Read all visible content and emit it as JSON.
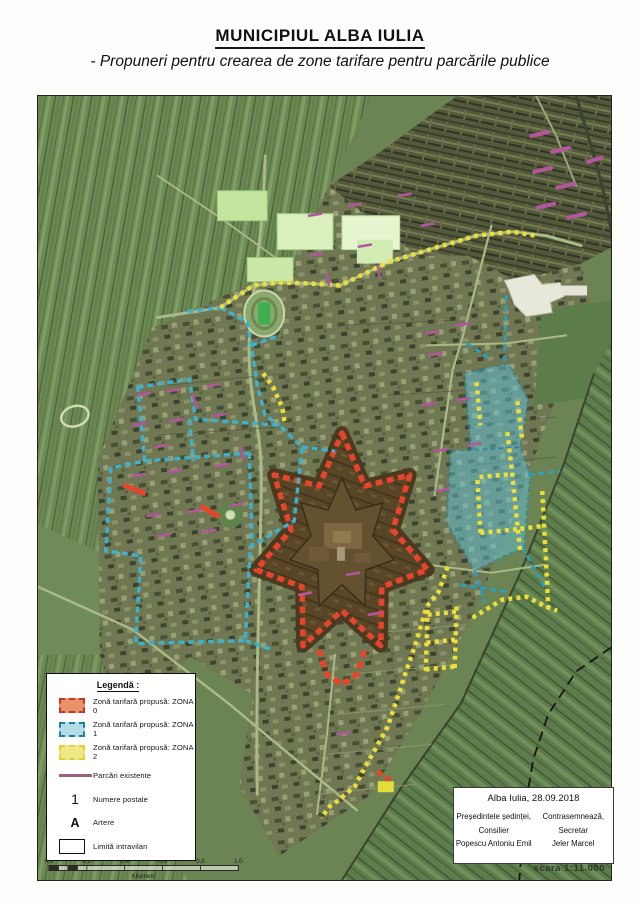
{
  "title": "MUNICIPIUL ALBA IULIA",
  "subtitle": "- Propuneri pentru crearea de zone tarifare pentru parcările publice",
  "legend": {
    "title": "Legendă :",
    "items": [
      {
        "label": "Zonă tarifară propusă: ZONA 0"
      },
      {
        "label": "Zonă tarifară propusă: ZONA 1"
      },
      {
        "label": "Zonă tarifară propusă: ZONA 2"
      },
      {
        "label": "Parcări existente"
      },
      {
        "label": "Numere postale",
        "symbol": "1"
      },
      {
        "label": "Artere",
        "symbol": "A"
      },
      {
        "label": "Limită intravilan"
      }
    ]
  },
  "stamp": {
    "date_line": "Alba Iulia, 28.09.2018",
    "left": {
      "role": "Președintele ședinței,",
      "title": "Consilier",
      "name": "Popescu Antoniu Emil"
    },
    "right": {
      "role": "Contrasemnează,",
      "title": "Secretar",
      "name": "Jeler Marcel"
    }
  },
  "scale": {
    "text": "scara 1:11.000",
    "ticks": [
      "0,0",
      "0,2",
      "0,4",
      "0,6",
      "0,8",
      "1,0"
    ],
    "unit": "Kilometri"
  },
  "colors": {
    "zona0_fill": "#e8916b",
    "zona0_stroke": "#d2432b",
    "zona1_fill": "#aedbe6",
    "zona1_stroke": "#2e93b0",
    "zona2_fill": "#efe985",
    "zona2_stroke": "#ddd23c",
    "parcari": "#9c5f82",
    "boundary": "#15150f"
  }
}
